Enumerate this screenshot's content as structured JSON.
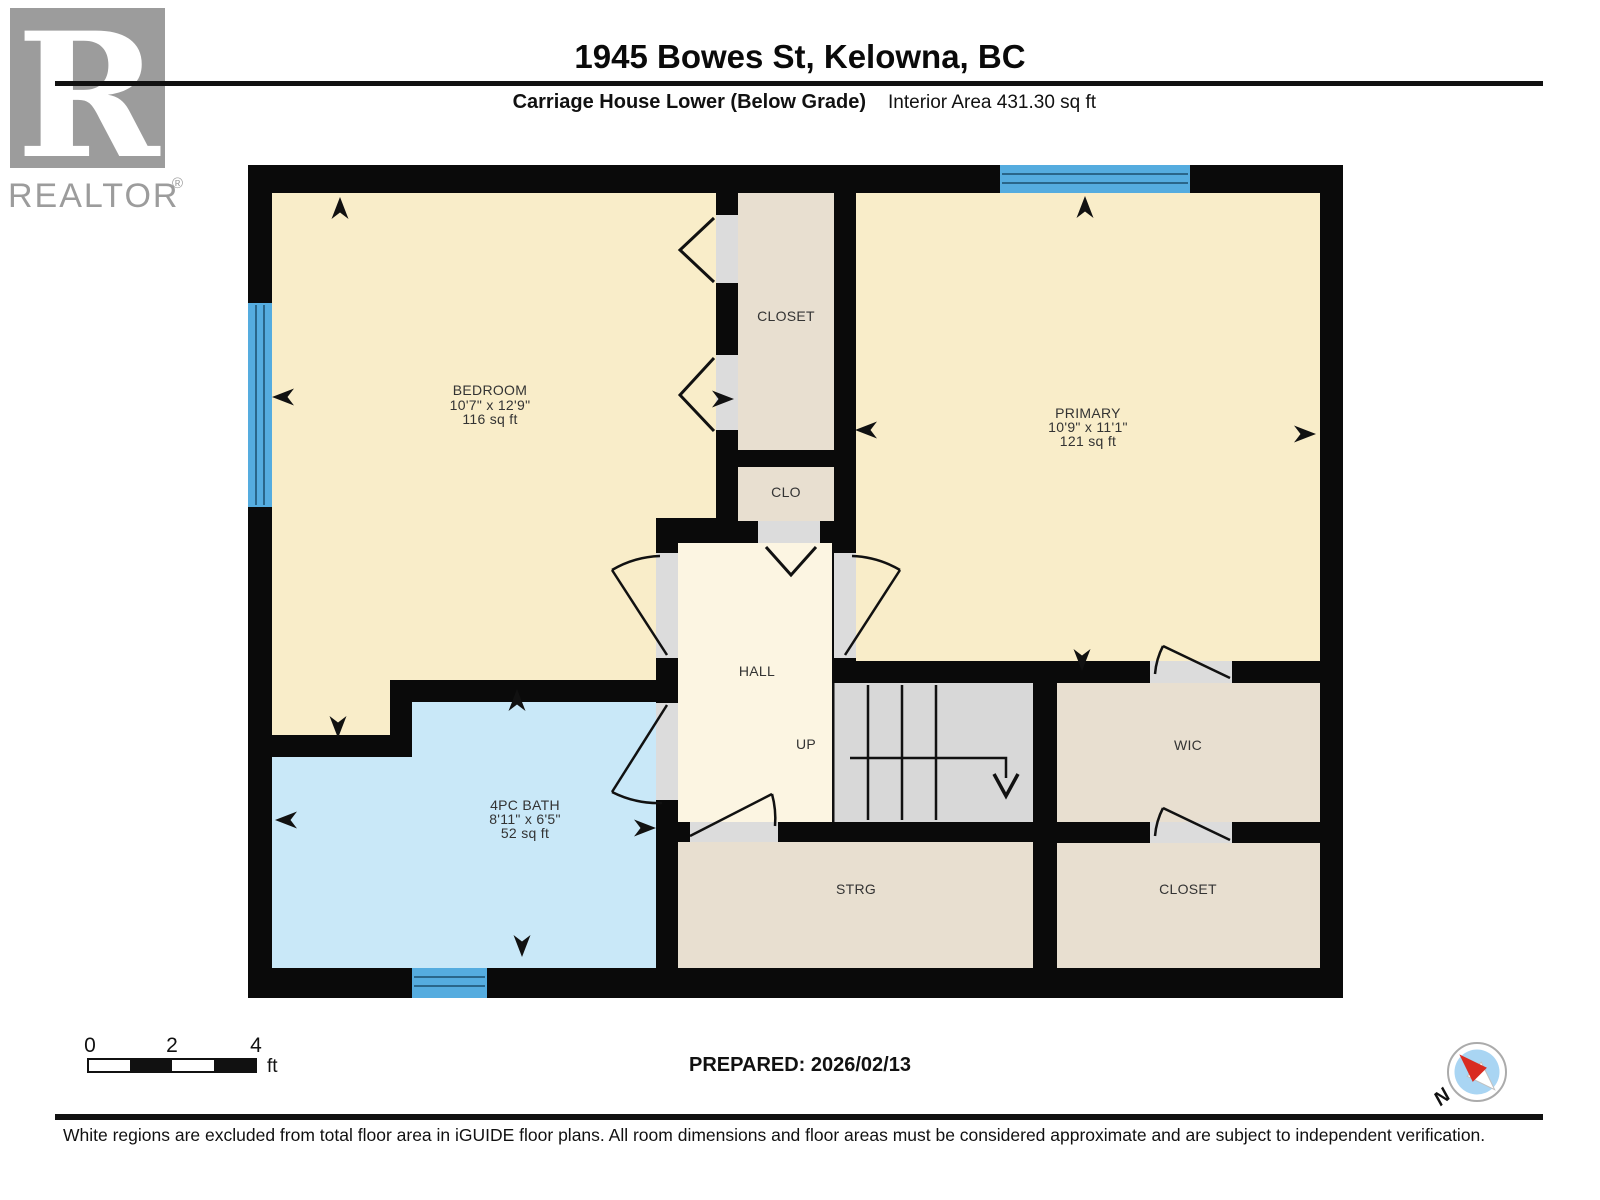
{
  "header": {
    "title": "1945 Bowes St, Kelowna, BC",
    "floor_label": "Carriage House Lower (Below Grade)",
    "interior_area": "Interior Area 431.30 sq ft",
    "logo_letter": "R",
    "brand": "REALTOR",
    "brand_reg": "®"
  },
  "rooms": {
    "bedroom": {
      "name": "BEDROOM",
      "dims": "10'7\" x 12'9\"",
      "area": "116 sq ft"
    },
    "primary": {
      "name": "PRIMARY",
      "dims": "10'9\" x 11'1\"",
      "area": "121 sq ft"
    },
    "bath": {
      "name": "4PC BATH",
      "dims": "8'11\" x 6'5\"",
      "area": "52 sq ft"
    },
    "closet_top": {
      "name": "CLOSET"
    },
    "clo": {
      "name": "CLO"
    },
    "hall": {
      "name": "HALL"
    },
    "stairs": {
      "up_label": "UP"
    },
    "wic": {
      "name": "WIC"
    },
    "strg": {
      "name": "STRG"
    },
    "closet_right": {
      "name": "CLOSET"
    }
  },
  "scale_bar": {
    "t0": "0",
    "t2": "2",
    "t4": "4",
    "unit": "ft"
  },
  "prepared_label": "PREPARED: 2026/02/13",
  "compass": {
    "north": "N"
  },
  "footer": {
    "disclaimer": "White regions are excluded from total floor area in iGUIDE floor plans. All room dimensions and floor areas must be considered approximate and are subject to independent verification."
  },
  "colors": {
    "wall": "#0a0a0a",
    "room_cream": "#F9EDC9",
    "hall_cream": "#FCF5E2",
    "closet_tan": "#E8DFD0",
    "bath_blue": "#C9E8F8",
    "stairs_gray": "#D8D8D8",
    "door_opening_gray": "#DCDCDC",
    "window_blue": "#55ACDF",
    "window_line": "#1D4E6E",
    "logo_gray": "#9C9C9C",
    "compass_blue": "#A9D5F3",
    "needle_red": "#D92B21"
  }
}
